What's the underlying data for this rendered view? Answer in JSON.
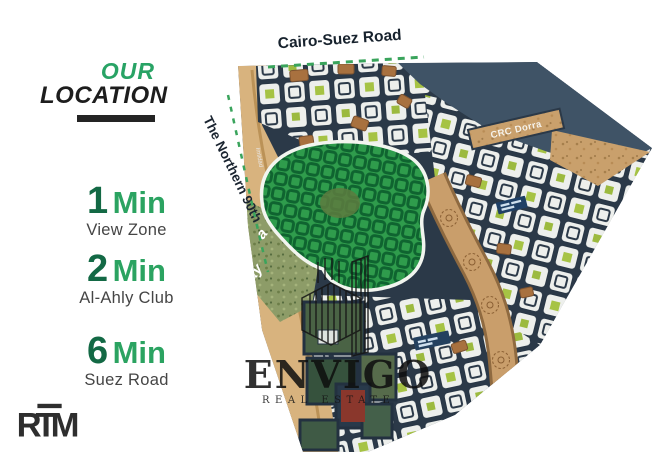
{
  "sidebar": {
    "title": {
      "line1": "OUR",
      "line2": "LOCATION"
    },
    "items": [
      {
        "value": "1",
        "unit": "Min",
        "label": "View Zone"
      },
      {
        "value": "2",
        "unit": "Min",
        "label": "Al-Ahly Club"
      },
      {
        "value": "6",
        "unit": "Min",
        "label": "Suez Road"
      }
    ],
    "logo": {
      "text": "RTM"
    }
  },
  "map": {
    "top_road": "Cairo-Suez Road",
    "left_road": "The Northern 90th",
    "compound_label": "CRC Dorra",
    "side_label": "Imtidad",
    "fragments": {
      "f1": "a",
      "f2": "ay"
    },
    "watermark": {
      "brand": "ENVIGO",
      "caption": "REAL ESTATE"
    }
  },
  "colors": {
    "accent_green": "#28a365",
    "number_green": "#136945",
    "text_dark": "#1d1d1d",
    "map_navy": "#2b3948",
    "map_slate": "#3f5366",
    "tan": "#d8b37e",
    "arc_road_tan": "#c99e6b",
    "brown_block": "#a8713f",
    "zone_green": "#2f9c4c",
    "zone_street": "#0f6430",
    "lime_pocket": "#a6c344",
    "dash_green": "#3aa45c",
    "street_white": "#edefec"
  }
}
